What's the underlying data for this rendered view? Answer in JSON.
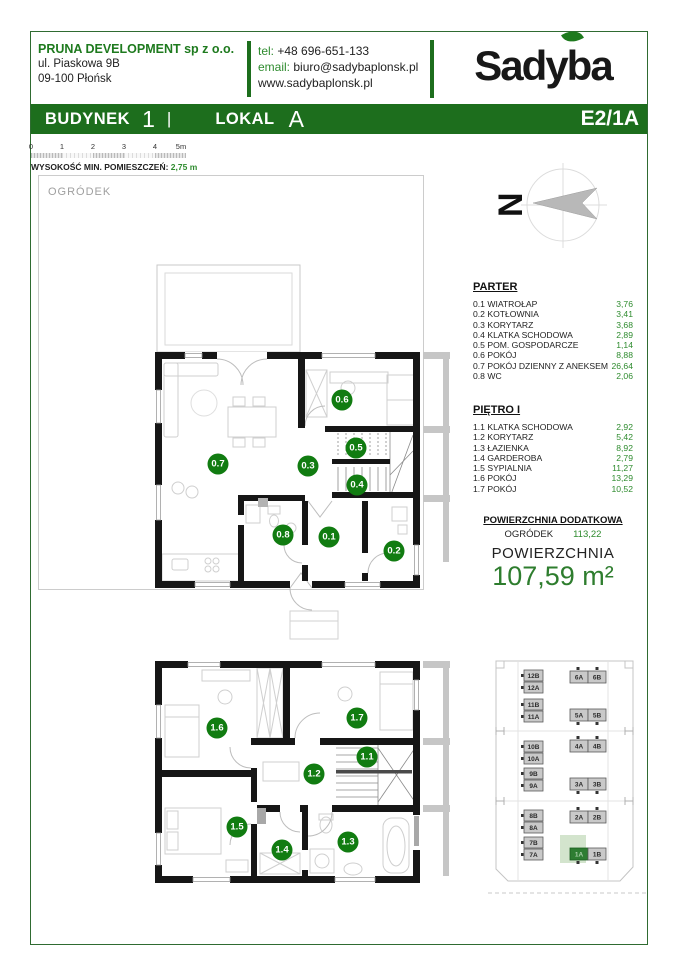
{
  "header": {
    "company_name": "PRUNA DEVELOPMENT sp z o.o.",
    "address1": "ul. Piaskowa 9B",
    "address2": "09-100 Płońsk",
    "tel_label": "tel:",
    "tel_value": "+48 696-651-133",
    "email_label": "email:",
    "email_value": "biuro@sadybaplonsk.pl",
    "www": "www.sadybaplonsk.pl",
    "logo_text": "Sadyba"
  },
  "title_bar": {
    "building_label": "BUDYNEK",
    "building_value": "1",
    "divider": "|",
    "unit_label": "LOKAL",
    "unit_value": "A",
    "code": "E2/1A"
  },
  "scale_bar": {
    "ticks": [
      "0",
      "1",
      "2",
      "3",
      "4",
      "5m"
    ],
    "note_label": "WYSOKOŚĆ MIN. POMIESZCZEŃ:",
    "note_value": "2,75 m"
  },
  "garden_label": "OGRÓDEK",
  "compass": {
    "label": "N"
  },
  "rooms": {
    "parter": {
      "title": "PARTER",
      "items": [
        {
          "label": "0.1 WIATROŁAP",
          "area": "3,76"
        },
        {
          "label": "0.2 KOTŁOWNIA",
          "area": "3,41"
        },
        {
          "label": "0.3 KORYTARZ",
          "area": "3,68"
        },
        {
          "label": "0.4 KLATKA SCHODOWA",
          "area": "2,89"
        },
        {
          "label": "0.5 POM. GOSPODARCZE",
          "area": "1,14"
        },
        {
          "label": "0.6 POKÓJ",
          "area": "8,88"
        },
        {
          "label": "0.7 POKÓJ DZIENNY Z ANEKSEM",
          "area": "26,64"
        },
        {
          "label": "0.8 WC",
          "area": "2,06"
        }
      ]
    },
    "pietro": {
      "title": "PIĘTRO I",
      "items": [
        {
          "label": "1.1 KLATKA SCHODOWA",
          "area": "2,92"
        },
        {
          "label": "1.2 KORYTARZ",
          "area": "5,42"
        },
        {
          "label": "1.3 ŁAZIENKA",
          "area": "8,92"
        },
        {
          "label": "1.4 GARDEROBA",
          "area": "2,79"
        },
        {
          "label": "1.5 SYPIALNIA",
          "area": "11,27"
        },
        {
          "label": "1.6 POKÓJ",
          "area": "13,29"
        },
        {
          "label": "1.7 POKÓJ",
          "area": "10,52"
        }
      ]
    }
  },
  "additional_area": {
    "title": "POWIERZCHNIA DODATKOWA",
    "name": "OGRÓDEK",
    "value": "113,22"
  },
  "total_area": {
    "label": "POWIERZCHNIA",
    "value": "107,59 m²"
  },
  "plan_badges": {
    "ground": [
      "0.1",
      "0.2",
      "0.3",
      "0.4",
      "0.5",
      "0.6",
      "0.7",
      "0.8"
    ],
    "first": [
      "1.1",
      "1.2",
      "1.3",
      "1.4",
      "1.5",
      "1.6",
      "1.7"
    ]
  },
  "site_map": {
    "left_units": [
      "12B",
      "12A",
      "11B",
      "11A",
      "10B",
      "10A",
      "9B",
      "9A",
      "8B",
      "8A",
      "7B",
      "7A"
    ],
    "right_units": [
      "6A",
      "6B",
      "5A",
      "5B",
      "4A",
      "4B",
      "3A",
      "3B",
      "2A",
      "2B",
      "1A",
      "1B"
    ],
    "highlight": "1A"
  },
  "colors": {
    "brand_green": "#1d6e1d",
    "accent_green": "#2e8b2e",
    "badge_green": "#117c11",
    "highlight_fill": "#2e7d32",
    "garden_green": "#d3e4cd"
  }
}
